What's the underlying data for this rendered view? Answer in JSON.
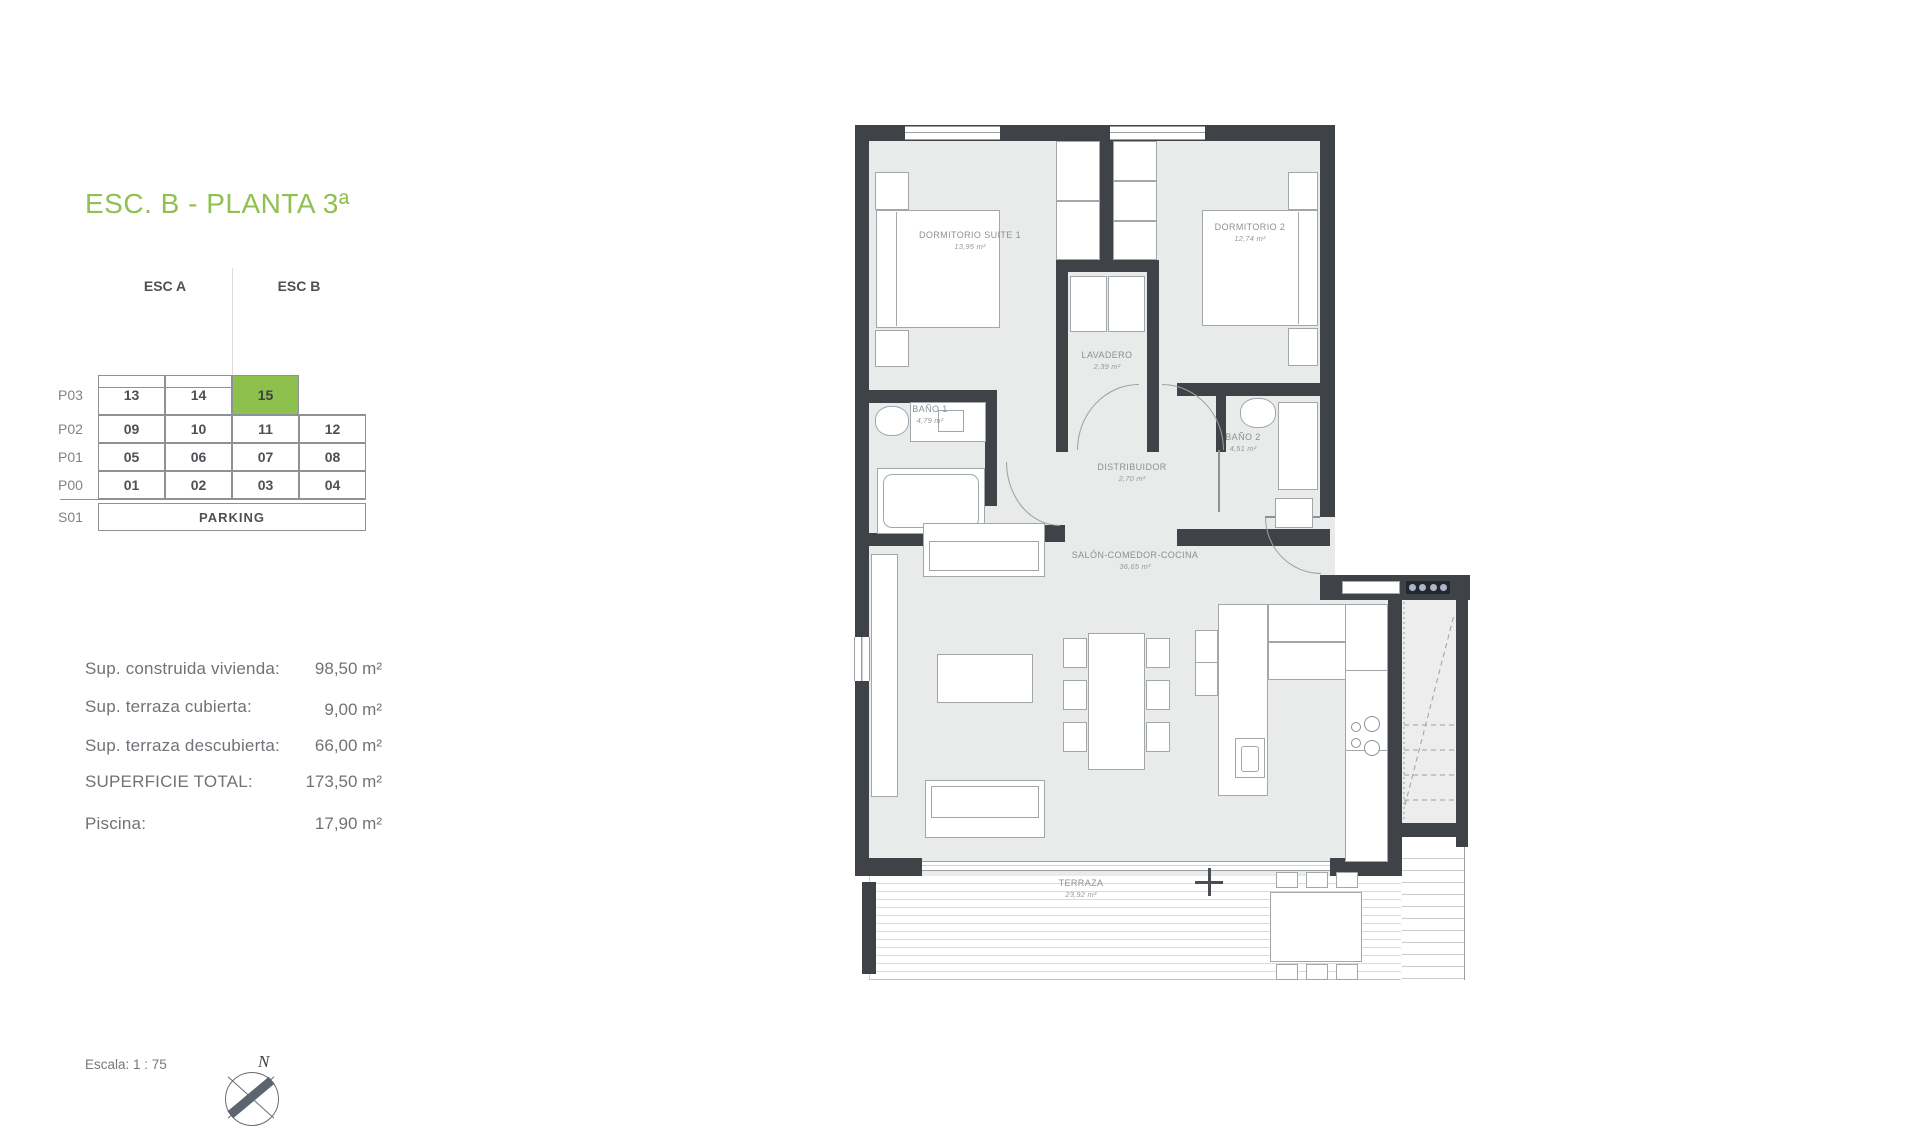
{
  "header": {
    "title": "ESC. B - PLANTA 3ª"
  },
  "colors": {
    "title_green": "#90bf52",
    "highlight_green": "#8dc04c",
    "wall_dark": "#3f4246",
    "room_fill": "#e9eaea"
  },
  "unit_table": {
    "col_headers": [
      "ESC A",
      "ESC B"
    ],
    "rows": [
      {
        "label": "P03",
        "cells": [
          "13",
          "14",
          "15"
        ],
        "highlighted_cell": "15"
      },
      {
        "label": "P02",
        "cells": [
          "09",
          "10",
          "11",
          "12"
        ]
      },
      {
        "label": "P01",
        "cells": [
          "05",
          "06",
          "07",
          "08"
        ]
      },
      {
        "label": "P00",
        "cells": [
          "01",
          "02",
          "03",
          "04"
        ]
      },
      {
        "label": "S01",
        "cells": [
          "PARKING"
        ]
      }
    ]
  },
  "areas": {
    "rows": [
      {
        "label": "Sup. construida vivienda:",
        "value": "98,50 m²"
      },
      {
        "label": "Sup. terraza cubierta:",
        "value": "9,00 m²"
      },
      {
        "label": "Sup. terraza descubierta:",
        "value": "66,00 m²"
      },
      {
        "label": "SUPERFICIE TOTAL:",
        "value": "173,50 m²"
      },
      {
        "label": "Piscina:",
        "value": "17,90 m²"
      }
    ]
  },
  "footer": {
    "scale_note": "Escala: 1 : 75",
    "compass_letter": "N"
  },
  "floor_plan": {
    "rooms": [
      {
        "name": "DORMITORIO SUITE 1",
        "area": "13,95 m²"
      },
      {
        "name": "DORMITORIO 2",
        "area": "12,74 m²"
      },
      {
        "name": "LAVADERO",
        "area": "2,39 m²"
      },
      {
        "name": "BAÑO 1",
        "area": "4,79 m²"
      },
      {
        "name": "BAÑO 2",
        "area": "4,51 m²"
      },
      {
        "name": "DISTRIBUIDOR",
        "area": "2,70 m²"
      },
      {
        "name": "SALÓN-COMEDOR-COCINA",
        "area": "36,65 m²"
      },
      {
        "name": "TERRAZA",
        "area": "23,92 m²"
      }
    ]
  }
}
